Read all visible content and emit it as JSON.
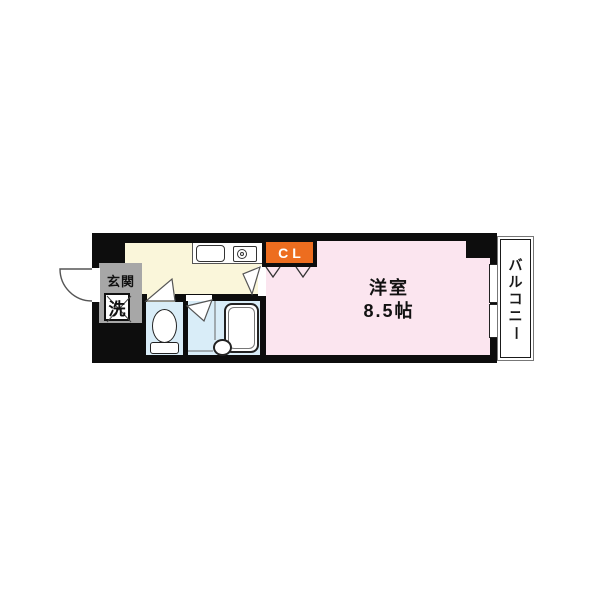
{
  "floorplan": {
    "rooms": {
      "entrance": {
        "label": "玄関"
      },
      "laundry": {
        "label": "洗"
      },
      "western_room": {
        "label": "洋室",
        "size": "8.5帖"
      },
      "closet": {
        "label": "CL"
      },
      "balcony": {
        "label": "バルコニー"
      }
    },
    "colors": {
      "wall": "#0d0d0d",
      "kitchen": "#faf6da",
      "western_room": "#fbe5ef",
      "wet_area": "#d9edf8",
      "entrance": "#a7a7a7",
      "closet": "#ed6d1f",
      "line": "#3a3a3a"
    }
  }
}
